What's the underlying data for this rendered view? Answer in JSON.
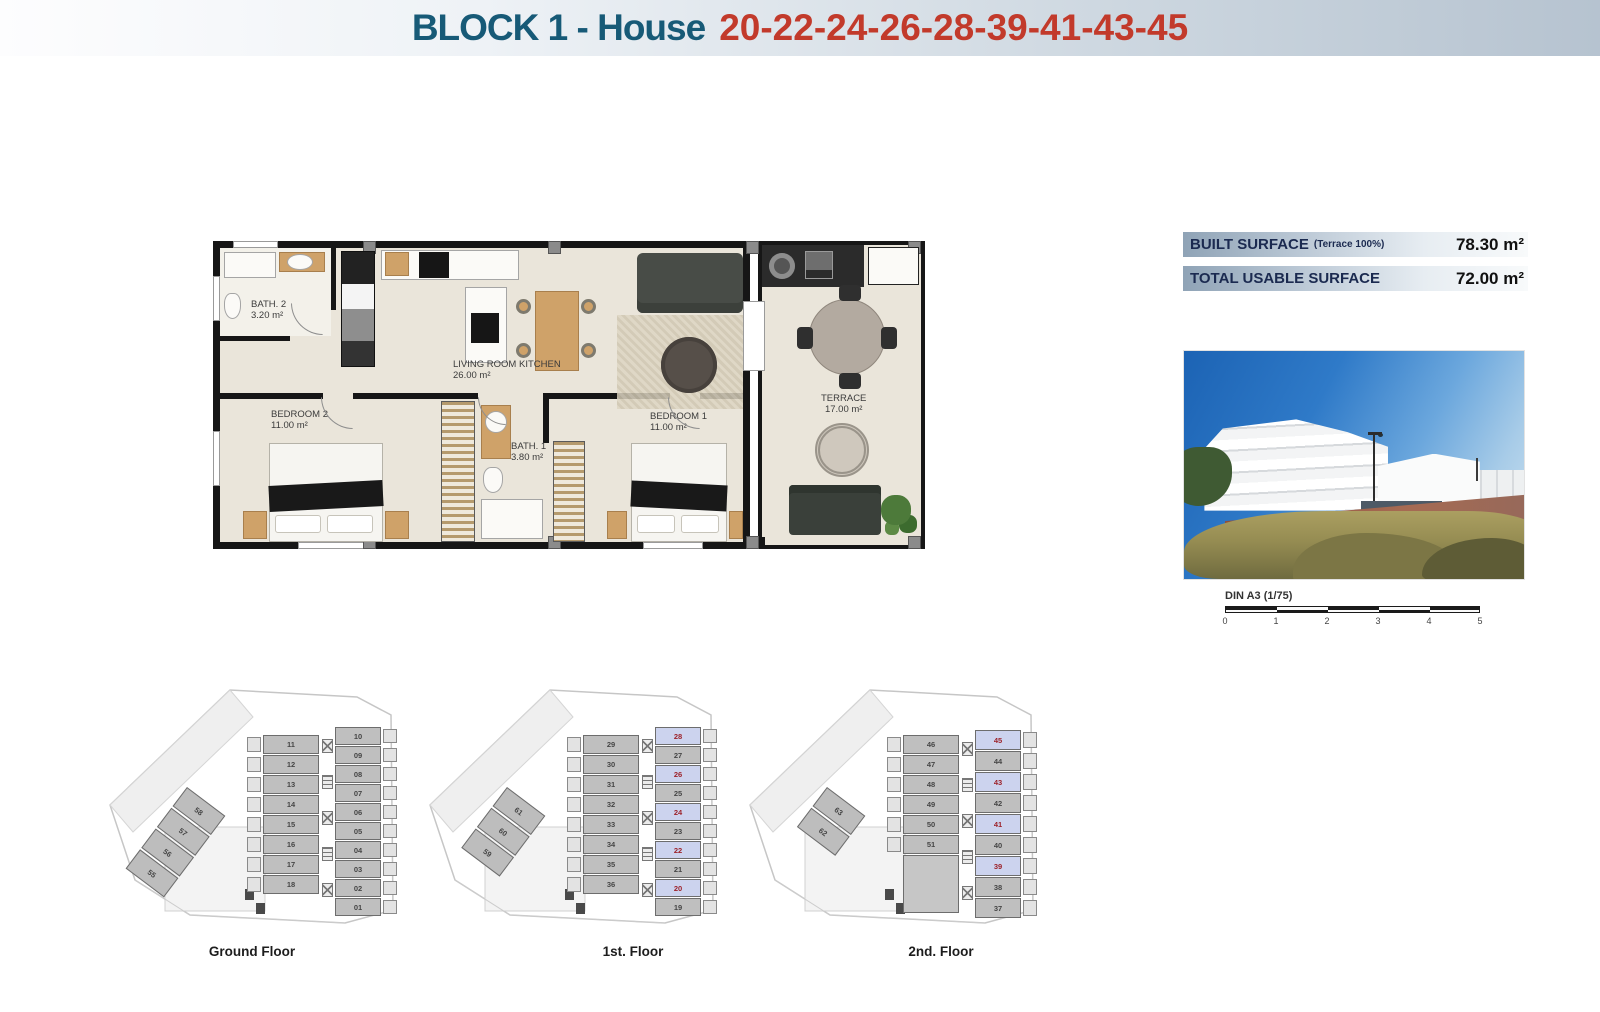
{
  "header": {
    "title_block": "BLOCK 1 - House",
    "title_numbers": "20-22-24-26-28-39-41-43-45"
  },
  "surfaces": {
    "built_label": "BUILT SURFACE",
    "built_note": "(Terrace 100%)",
    "built_value": "78.30 m²",
    "usable_label": "TOTAL USABLE SURFACE",
    "usable_value": "72.00 m²"
  },
  "plan": {
    "rooms": [
      {
        "name": "BATH. 2",
        "area": "3.20 m²"
      },
      {
        "name": "LIVING ROOM KITCHEN",
        "area": "26.00 m²"
      },
      {
        "name": "BEDROOM 2",
        "area": "11.00 m²"
      },
      {
        "name": "BATH. 1",
        "area": "3.80 m²"
      },
      {
        "name": "BEDROOM 1",
        "area": "11.00 m²"
      },
      {
        "name": "TERRACE",
        "area": "17.00 m²"
      }
    ]
  },
  "scale": {
    "label": "DIN A3 (1/75)",
    "ticks": [
      "0",
      "1",
      "2",
      "3",
      "4",
      "5"
    ]
  },
  "floors": [
    {
      "label": "Ground Floor",
      "left_units": [
        "11",
        "12",
        "13",
        "14",
        "15",
        "16",
        "17",
        "18"
      ],
      "right_units": [
        "10",
        "09",
        "08",
        "07",
        "06",
        "05",
        "04",
        "03",
        "02",
        "01"
      ],
      "diag_units": [
        "58",
        "57",
        "56",
        "55"
      ],
      "highlights": []
    },
    {
      "label": "1st. Floor",
      "left_units": [
        "29",
        "30",
        "31",
        "32",
        "33",
        "34",
        "35",
        "36"
      ],
      "right_units": [
        "28",
        "27",
        "26",
        "25",
        "24",
        "23",
        "22",
        "21",
        "20",
        "19"
      ],
      "diag_units": [
        "61",
        "60",
        "59"
      ],
      "highlights": [
        "28",
        "26",
        "24",
        "22",
        "20"
      ]
    },
    {
      "label": "2nd. Floor",
      "left_units": [
        "46",
        "47",
        "48",
        "49",
        "50",
        "51"
      ],
      "right_units": [
        "45",
        "44",
        "43",
        "42",
        "41",
        "40",
        "39",
        "38",
        "37"
      ],
      "diag_units": [
        "63",
        "62"
      ],
      "highlights": [
        "45",
        "43",
        "41",
        "39"
      ]
    }
  ],
  "colors": {
    "header_blue": "#175a77",
    "header_red": "#c23a2b",
    "bar_navy": "#1b2a50",
    "highlight_bg": "#ccd3ee",
    "highlight_text": "#9c2129",
    "unit_bg": "#bfbfbf"
  }
}
